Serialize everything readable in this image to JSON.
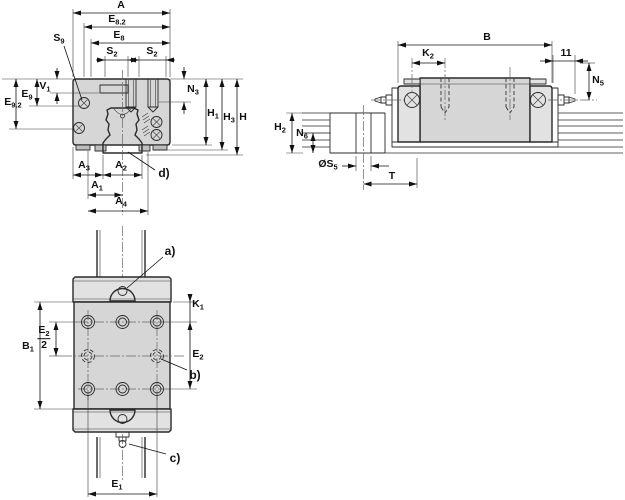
{
  "drawing_type": "linear-guide-carriage-dimension-drawing",
  "colors": {
    "background": "#ffffff",
    "part_fill": "#d6d6d6",
    "part_fill_light": "#e2e2e2",
    "line": "#2b2b2b"
  },
  "section_view": {
    "A": {
      "main": "A",
      "sub": ""
    },
    "E82": {
      "main": "E",
      "sub": "8.2"
    },
    "E8": {
      "main": "E",
      "sub": "8"
    },
    "S2a": {
      "main": "S",
      "sub": "2"
    },
    "S2b": {
      "main": "S",
      "sub": "2"
    },
    "S9": {
      "main": "S",
      "sub": "9"
    },
    "V1": {
      "main": "V",
      "sub": "1"
    },
    "E9": {
      "main": "E",
      "sub": "9"
    },
    "E92": {
      "main": "E",
      "sub": "9.2"
    },
    "N3": {
      "main": "N",
      "sub": "3"
    },
    "H1": {
      "main": "H",
      "sub": "1"
    },
    "H3": {
      "main": "H",
      "sub": "3"
    },
    "H": {
      "main": "H",
      "sub": ""
    },
    "A3": {
      "main": "A",
      "sub": "3"
    },
    "A2": {
      "main": "A",
      "sub": "2"
    },
    "A1": {
      "main": "A",
      "sub": "1"
    },
    "A4": {
      "main": "A",
      "sub": "4"
    },
    "d": "d)"
  },
  "side_view": {
    "B": {
      "main": "B",
      "sub": ""
    },
    "K2": {
      "main": "K",
      "sub": "2"
    },
    "eleven": {
      "main": "11",
      "sub": ""
    },
    "N5": {
      "main": "N",
      "sub": "5"
    },
    "H2": {
      "main": "H",
      "sub": "2"
    },
    "N6": {
      "main": "N",
      "sub": "6"
    },
    "S5": {
      "main": "ØS",
      "sub": "5"
    },
    "T": {
      "main": "T",
      "sub": ""
    }
  },
  "top_view": {
    "a": "a)",
    "b": "b)",
    "c": "c)",
    "K1": {
      "main": "K",
      "sub": "1"
    },
    "E2half": {
      "num_main": "E",
      "num_sub": "2",
      "den": "2"
    },
    "B1": {
      "main": "B",
      "sub": "1"
    },
    "E2": {
      "main": "E",
      "sub": "2"
    },
    "E1": {
      "main": "E",
      "sub": "1"
    }
  }
}
